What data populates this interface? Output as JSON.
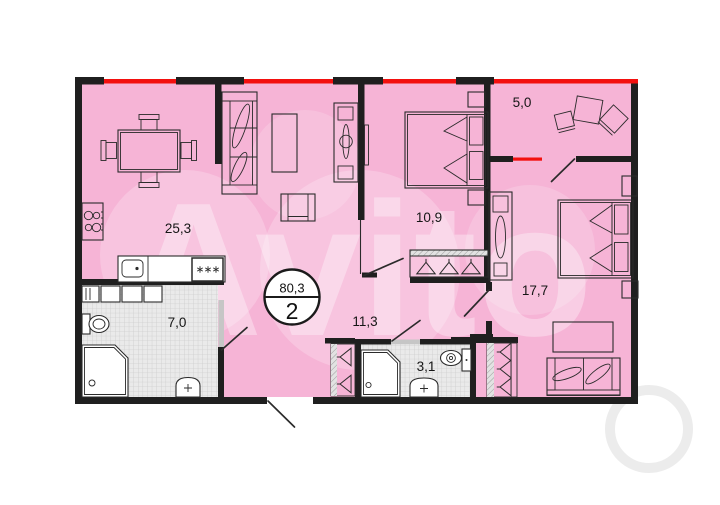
{
  "plan": {
    "badge": {
      "total_area": "80,3",
      "rooms_count": "2"
    },
    "rooms": [
      {
        "name": "kitchen-living-room",
        "area": "25,3"
      },
      {
        "name": "bedroom-1",
        "area": "10,9"
      },
      {
        "name": "balcony",
        "area": "5,0"
      },
      {
        "name": "bedroom-2",
        "area": "17,7"
      },
      {
        "name": "bathroom",
        "area": "7,0"
      },
      {
        "name": "hallway",
        "area": "11,3"
      },
      {
        "name": "shower-room",
        "area": "3,1"
      }
    ],
    "watermark": "Avito",
    "colors": {
      "pink": "#f6b4d6",
      "wall": "#1f1f1f",
      "window_red": "#f3100e",
      "tile_gray": "#eaeaea",
      "badge_bg": "#ffffff"
    }
  }
}
